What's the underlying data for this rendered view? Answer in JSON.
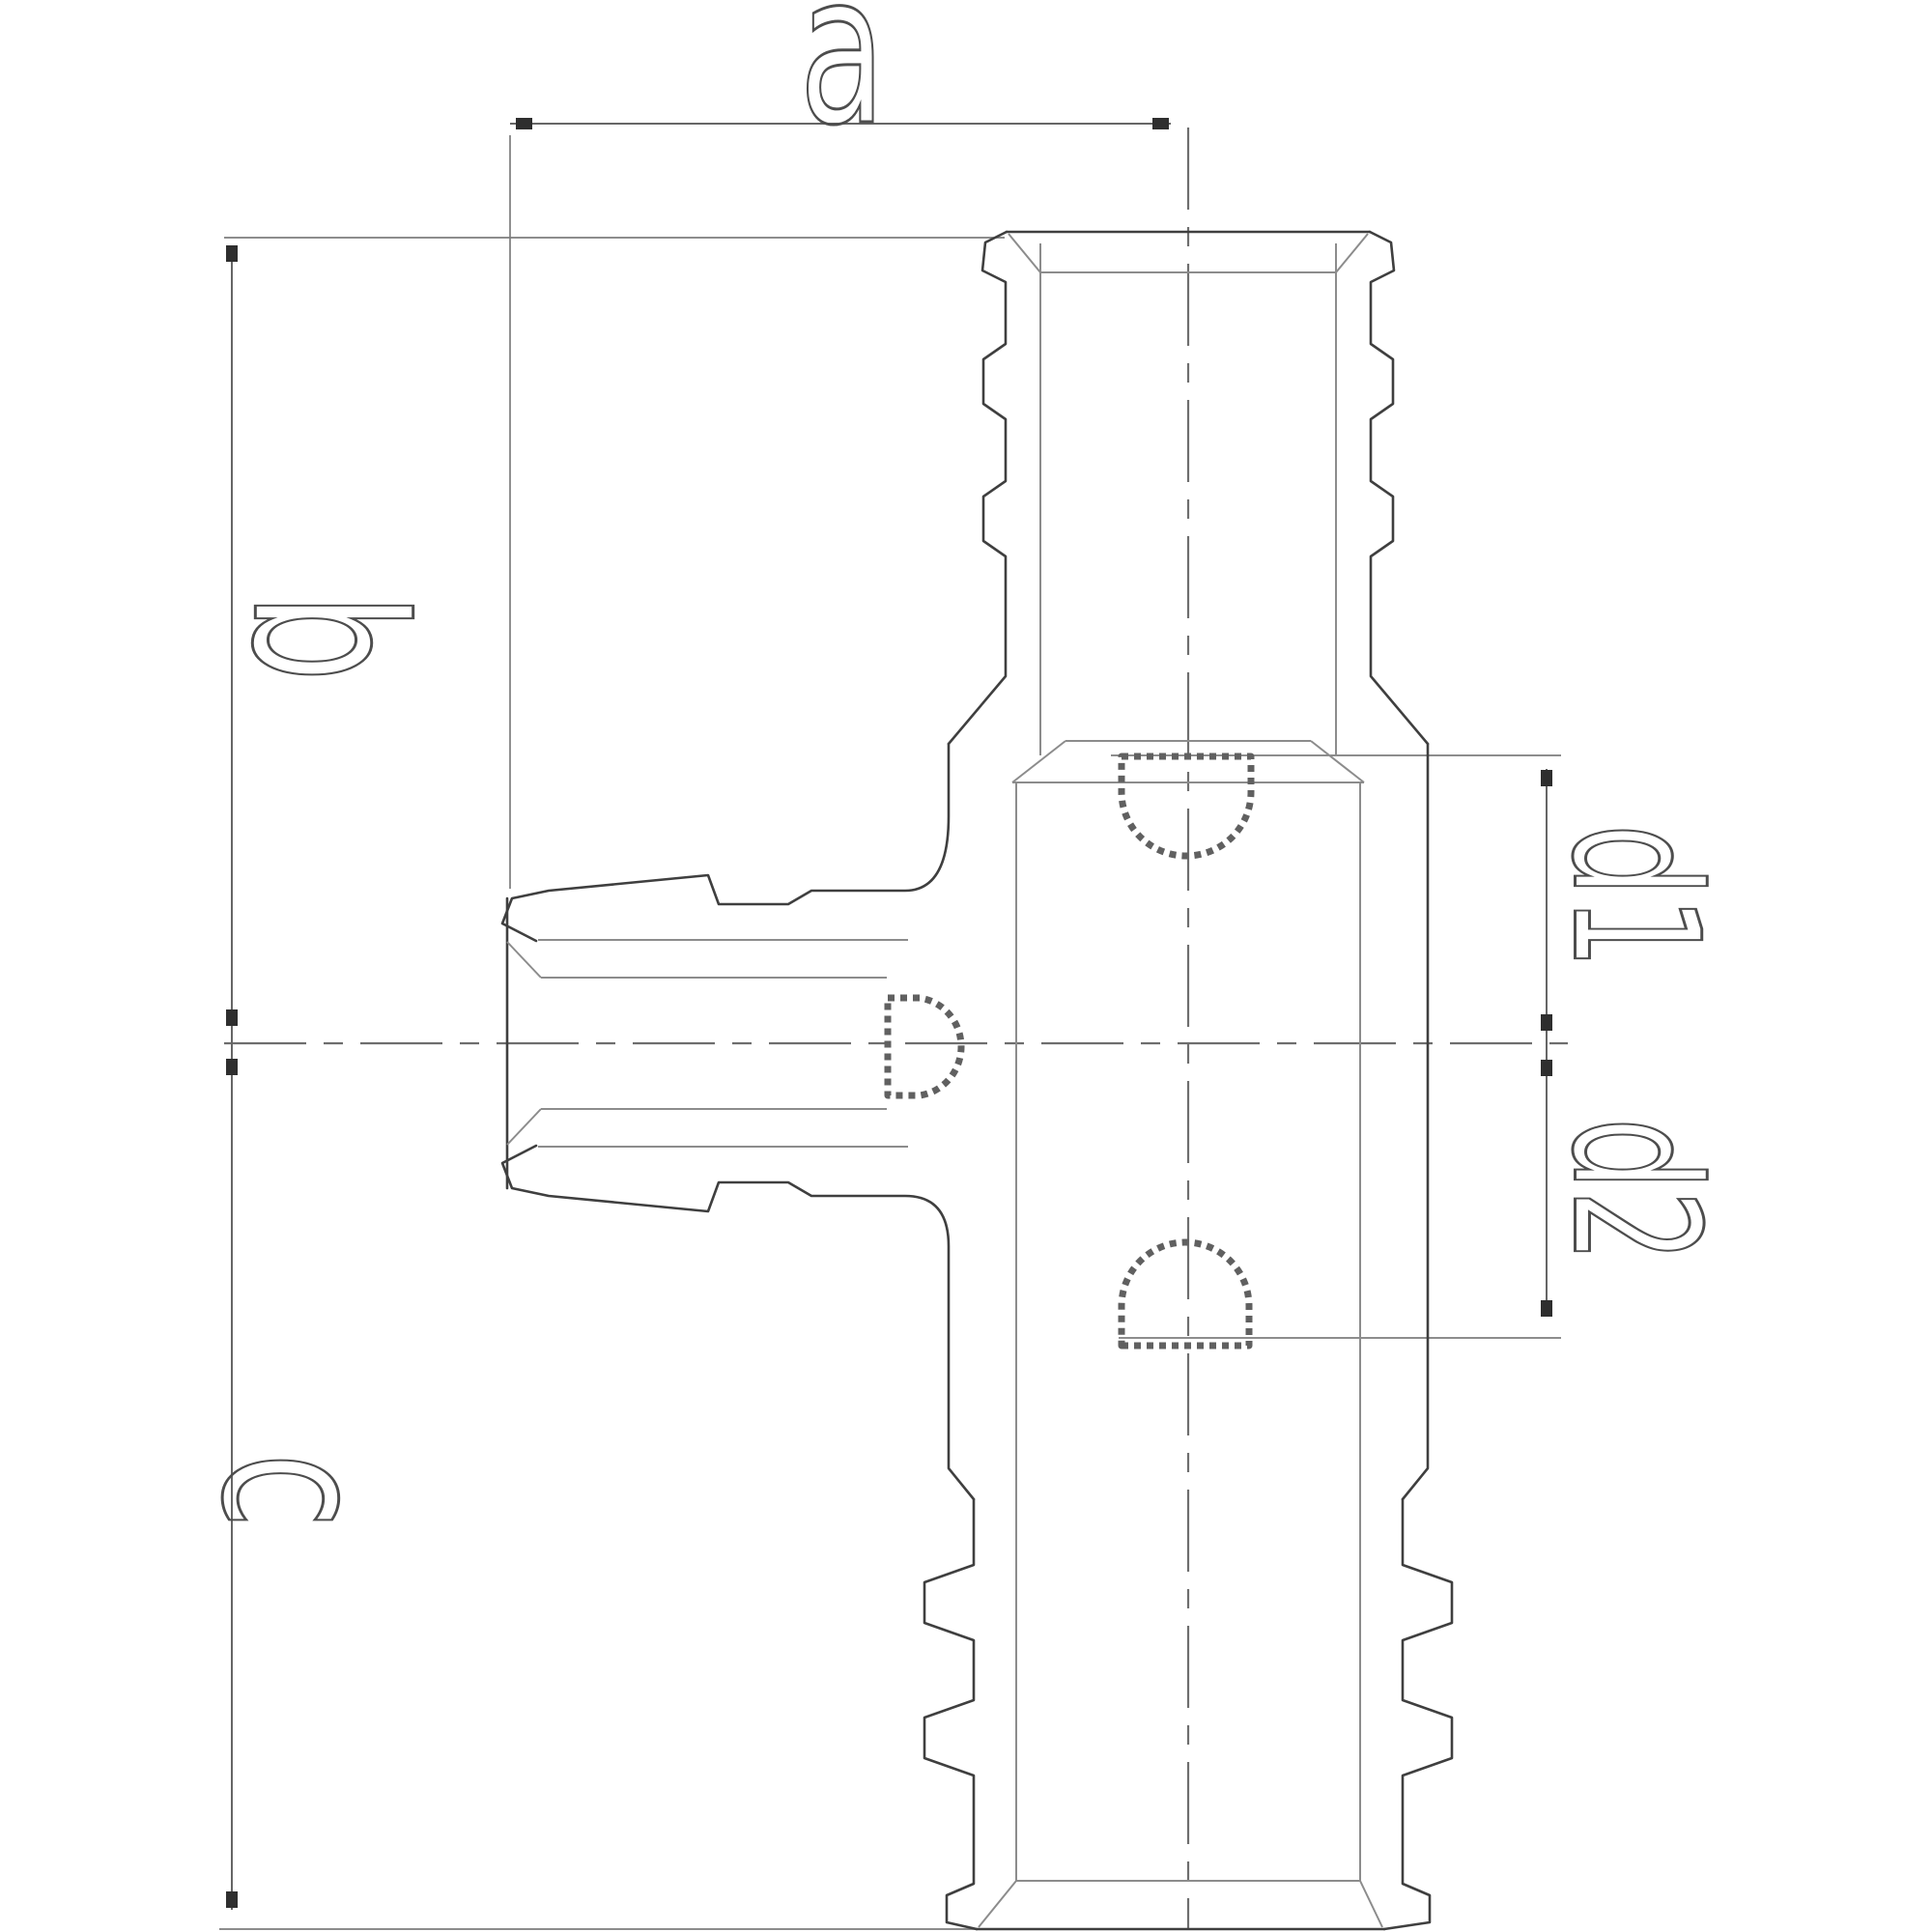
{
  "drawing": {
    "labels": {
      "a": "a",
      "b": "b",
      "c": "c",
      "d1": "d1",
      "d2": "d2"
    },
    "colors": {
      "background": "#ffffff",
      "outline": "#3f3f3f",
      "detail_lines": "#8c8c8c",
      "dimension_lines": "#666666",
      "extension_lines": "#7d7d7d",
      "centerlines": "#6e6e6e",
      "clip_symbol": "#606060",
      "label_text": "#4d4d4d"
    }
  }
}
